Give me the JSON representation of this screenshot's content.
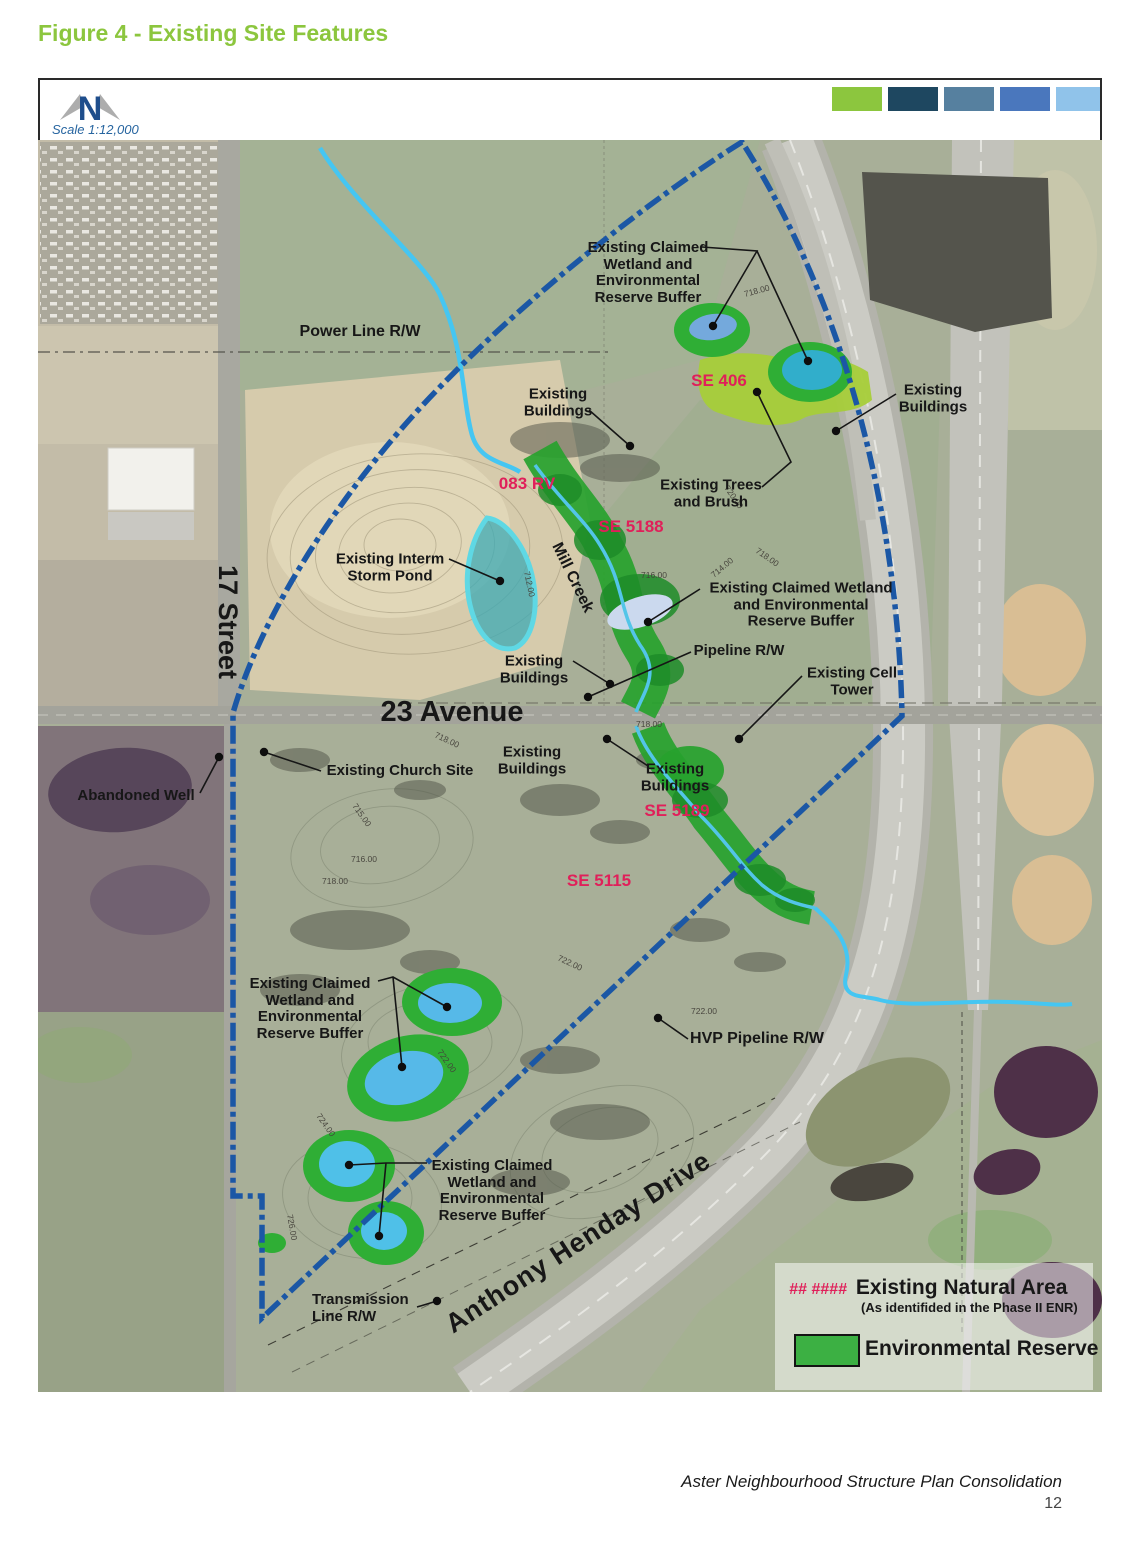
{
  "title": "Figure 4 - Existing Site Features",
  "map": {
    "north_label": "N",
    "scale_label": "Scale 1:12,000",
    "swatches": [
      "#8CC63E",
      "#1E4760",
      "#56809F",
      "#4A77BD",
      "#90C3EA"
    ],
    "accent_colors": {
      "boundary_blue": "#1B57A5",
      "reserve_green": "#2FAE35",
      "natural_area_green": "#A6CE39",
      "wetland_blue": "#56B9E8",
      "storm_pond_teal": "#3FAEB5",
      "creek_cyan": "#49C8F0",
      "label_red": "#E0205A"
    },
    "labels": {
      "power_line": {
        "text": "Power Line R/W"
      },
      "wetland_top": {
        "text": "Existing Claimed\nWetland and\nEnvironmental\nReserve Buffer"
      },
      "buildings_1": {
        "text": "Existing\nBuildings"
      },
      "buildings_2": {
        "text": "Existing\nBuildings"
      },
      "trees_brush": {
        "text": "Existing Trees\nand Brush"
      },
      "storm_pond": {
        "text": "Existing Interm\nStorm Pond"
      },
      "wetland_mid": {
        "text": "Existing Claimed Wetland\nand Environmental\nReserve Buffer"
      },
      "buildings_3": {
        "text": "Existing\nBuildings"
      },
      "pipeline": {
        "text": "Pipeline R/W"
      },
      "cell_tower": {
        "text": "Existing Cell\nTower"
      },
      "avenue_23": {
        "text": "23 Avenue"
      },
      "street_17": {
        "text": "17 Street"
      },
      "church": {
        "text": "Existing Church Site"
      },
      "abandoned_well": {
        "text": "Abandoned Well"
      },
      "buildings_4": {
        "text": "Existing\nBuildings"
      },
      "buildings_5": {
        "text": "Existing\nBuildings"
      },
      "se406": {
        "text": "SE 406"
      },
      "rv083": {
        "text": "083 RV"
      },
      "se5188": {
        "text": "SE 5188"
      },
      "se5189": {
        "text": "SE 5189"
      },
      "se5115": {
        "text": "SE 5115"
      },
      "wetland_sw": {
        "text": "Existing Claimed\nWetland and\nEnvironmental\nReserve Buffer"
      },
      "hvp_pipeline": {
        "text": "HVP Pipeline R/W"
      },
      "henday": {
        "text": "Anthony Henday Drive"
      },
      "wetland_s": {
        "text": "Existing Claimed\nWetland and\nEnvironmental\nReserve Buffer"
      },
      "transmission": {
        "text": "Transmission\nLine R/W"
      },
      "mill_creek": {
        "text": "Mill Creek"
      }
    },
    "contour_labels": [
      {
        "t": "718.00",
        "x": 745,
        "y": 297,
        "r": -15
      },
      {
        "t": "718.00",
        "x": 755,
        "y": 552,
        "r": 35
      },
      {
        "t": "716.00",
        "x": 641,
        "y": 578,
        "r": 0
      },
      {
        "t": "714.00",
        "x": 714,
        "y": 578,
        "r": -40
      },
      {
        "t": "712.00",
        "x": 524,
        "y": 572,
        "r": 78
      },
      {
        "t": "720.00",
        "x": 724,
        "y": 488,
        "r": 55
      },
      {
        "t": "718.00",
        "x": 434,
        "y": 737,
        "r": 25
      },
      {
        "t": "715.00",
        "x": 352,
        "y": 806,
        "r": 55
      },
      {
        "t": "718.00",
        "x": 636,
        "y": 727,
        "r": 0
      },
      {
        "t": "716.00",
        "x": 351,
        "y": 862,
        "r": 0
      },
      {
        "t": "718.00",
        "x": 322,
        "y": 884,
        "r": 0
      },
      {
        "t": "722.00",
        "x": 557,
        "y": 960,
        "r": 25
      },
      {
        "t": "722.00",
        "x": 691,
        "y": 1014,
        "r": 0
      },
      {
        "t": "724.00",
        "x": 316,
        "y": 1116,
        "r": 55
      },
      {
        "t": "722.00",
        "x": 437,
        "y": 1052,
        "r": 55
      },
      {
        "t": "726.00",
        "x": 287,
        "y": 1215,
        "r": 80
      }
    ],
    "leaders": [
      {
        "pts": [
          [
            702,
            247
          ],
          [
            757,
            251
          ],
          [
            713,
            326
          ]
        ],
        "dot": [
          713,
          326
        ]
      },
      {
        "pts": [
          [
            757,
            251
          ],
          [
            808,
            361
          ]
        ],
        "dot": [
          808,
          361
        ]
      },
      {
        "pts": [
          [
            589,
            410
          ],
          [
            630,
            446
          ]
        ],
        "dot": [
          630,
          446
        ]
      },
      {
        "pts": [
          [
            896,
            394
          ],
          [
            836,
            431
          ]
        ],
        "dot": [
          836,
          431
        ]
      },
      {
        "pts": [
          [
            762,
            487
          ],
          [
            791,
            462
          ],
          [
            757,
            392
          ]
        ],
        "dot": [
          757,
          392
        ]
      },
      {
        "pts": [
          [
            449,
            559
          ],
          [
            500,
            581
          ]
        ],
        "dot": [
          500,
          581
        ]
      },
      {
        "pts": [
          [
            700,
            589
          ],
          [
            648,
            622
          ]
        ],
        "dot": [
          648,
          622
        ]
      },
      {
        "pts": [
          [
            691,
            652
          ],
          [
            588,
            697
          ]
        ],
        "dot": [
          588,
          697
        ]
      },
      {
        "pts": [
          [
            802,
            676
          ],
          [
            739,
            739
          ]
        ],
        "dot": [
          739,
          739
        ]
      },
      {
        "pts": [
          [
            321,
            771
          ],
          [
            264,
            752
          ]
        ],
        "dot": [
          264,
          752
        ]
      },
      {
        "pts": [
          [
            200,
            793
          ],
          [
            219,
            757
          ]
        ],
        "dot": [
          219,
          757
        ]
      },
      {
        "pts": [
          [
            648,
            766
          ],
          [
            607,
            739
          ]
        ],
        "dot": [
          607,
          739
        ]
      },
      {
        "pts": [
          [
            573,
            661
          ],
          [
            610,
            684
          ]
        ],
        "dot": [
          610,
          684
        ]
      },
      {
        "pts": [
          [
            378,
            981
          ],
          [
            393,
            977
          ],
          [
            447,
            1007
          ]
        ],
        "dot": [
          447,
          1007
        ]
      },
      {
        "pts": [
          [
            393,
            977
          ],
          [
            402,
            1067
          ]
        ],
        "dot": [
          402,
          1067
        ]
      },
      {
        "pts": [
          [
            688,
            1039
          ],
          [
            658,
            1018
          ]
        ],
        "dot": [
          658,
          1018
        ]
      },
      {
        "pts": [
          [
            427,
            1163
          ],
          [
            386,
            1163
          ],
          [
            349,
            1165
          ]
        ],
        "dot": [
          349,
          1165
        ]
      },
      {
        "pts": [
          [
            386,
            1163
          ],
          [
            379,
            1236
          ]
        ],
        "dot": [
          379,
          1236
        ]
      },
      {
        "pts": [
          [
            417,
            1307
          ],
          [
            437,
            1301
          ]
        ],
        "dot": [
          437,
          1301
        ]
      }
    ]
  },
  "legend": {
    "natural_area_code": "## ####",
    "natural_area_label": "Existing Natural Area",
    "natural_area_sub": "(As identifided in the Phase II ENR)",
    "reserve_label": "Environmental Reserve"
  },
  "footer": {
    "text": "Aster Neighbourhood Structure Plan Consolidation",
    "page": "12"
  }
}
